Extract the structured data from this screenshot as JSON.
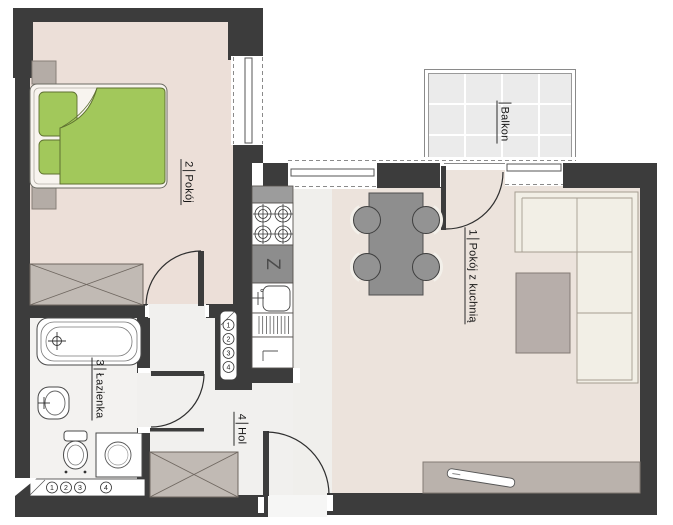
{
  "rooms": {
    "bedroom": {
      "number": "2",
      "label": "Pokój"
    },
    "living": {
      "number": "1",
      "label": "Pokój z kuchnią"
    },
    "bathroom": {
      "number": "3",
      "label": "Łazienka"
    },
    "hall": {
      "number": "4",
      "label": "Hol"
    },
    "balcony": {
      "label": "Balkon"
    }
  },
  "symbols": {
    "dishwasher": "Z"
  },
  "risers": {
    "kitchen_stack": [
      "1",
      "2",
      "3",
      "4"
    ],
    "bathroom_row": [
      "1",
      "2",
      "3",
      "4"
    ]
  },
  "colors": {
    "wall": "#3c3c3c",
    "bedroom_floor": "#ecdfd8",
    "living_floor": "#ece3dc",
    "hall_floor": "#f1f0ee",
    "bathroom_floor": "#f3f2f0",
    "kitchen_floor": "#f5f4f2",
    "balcony_floor": "#ebebeb",
    "bed_green": "#a2c85b",
    "furniture_gray": "#8e8e8e",
    "sofa_cream": "#f2efe6"
  }
}
